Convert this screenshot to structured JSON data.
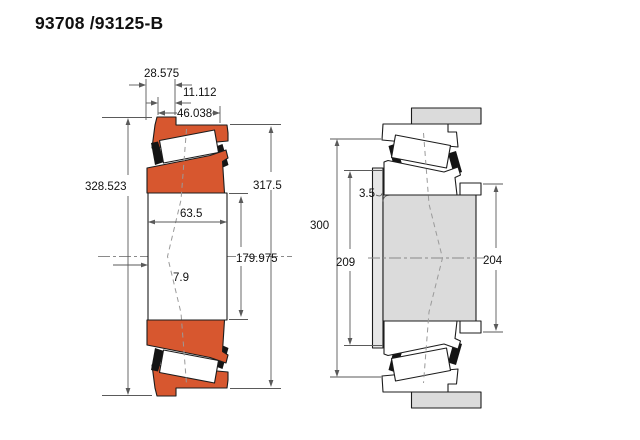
{
  "title": "93708 /93125-B",
  "left_view": {
    "description": "bearing cross-section",
    "dims": {
      "cup_width": "28.575",
      "stand_out": "11.112",
      "total_width": "46.038",
      "flange_diameter": "328.523",
      "outer_diameter": "317.5",
      "spread": "63.5",
      "bore_diameter": "179.975",
      "offset": "7.9"
    }
  },
  "right_view": {
    "description": "mounted arrangement",
    "dims": {
      "fillet_radius": "3.5",
      "housing_shoulder_diameter": "300",
      "shaft_shoulder_diameter": "209",
      "spacer_diameter": "204"
    }
  },
  "colors": {
    "bearing_fill": "#d7572f",
    "metal_fill": "#dbdbdb",
    "shoulder_fill": "#e6e6e6",
    "cage_fill": "#141414",
    "outline": "#1c1c1c",
    "dim_line": "#5a5a5a",
    "text": "#111111",
    "background": "#ffffff"
  }
}
